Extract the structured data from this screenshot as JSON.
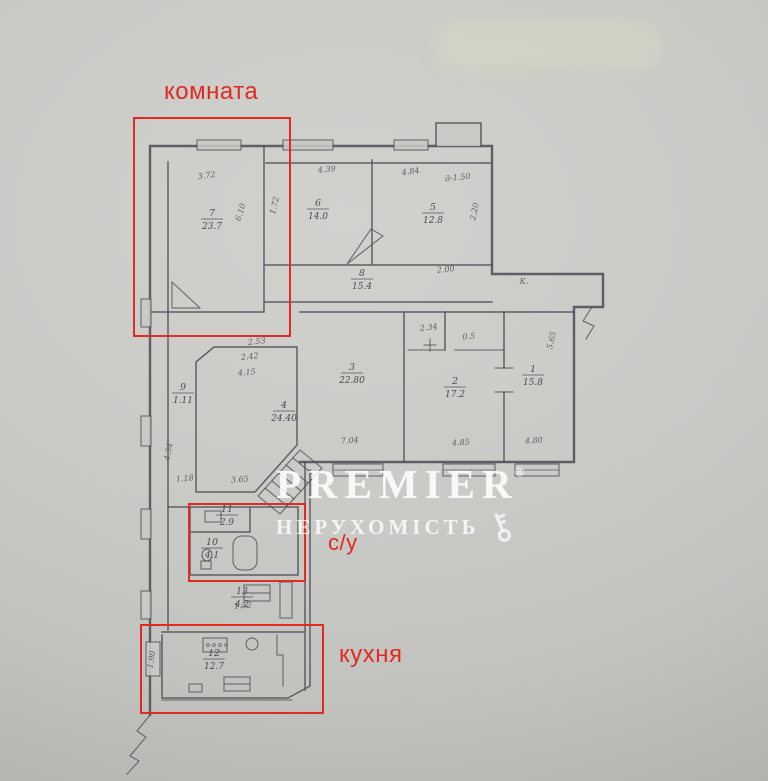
{
  "labels": {
    "room": "комната",
    "bathroom": "с/у",
    "kitchen": "кухня"
  },
  "watermark": {
    "brand": "PREMIER",
    "reg": "®",
    "subtitle": "НЕРУХОМІСТЬ",
    "key_icon": "key-icon"
  },
  "colors": {
    "annotation": "#e02a22",
    "ink": "#4e5055",
    "paper": "#c9c9c6",
    "watermark": "#ffffff"
  },
  "plan": {
    "rooms": [
      {
        "n": "7",
        "a": "23.7",
        "x": 212,
        "y": 216
      },
      {
        "n": "6",
        "a": "14.0",
        "x": 318,
        "y": 206
      },
      {
        "n": "5",
        "a": "12.8",
        "x": 433,
        "y": 210
      },
      {
        "n": "8",
        "a": "15.4",
        "x": 362,
        "y": 276
      },
      {
        "n": "9",
        "a": "1.11",
        "x": 183,
        "y": 390
      },
      {
        "n": "4",
        "a": "24.40",
        "x": 284,
        "y": 408
      },
      {
        "n": "3",
        "a": "22.80",
        "x": 352,
        "y": 370
      },
      {
        "n": "2",
        "a": "17.2",
        "x": 455,
        "y": 384
      },
      {
        "n": "1",
        "a": "15.8",
        "x": 533,
        "y": 372
      },
      {
        "n": "11",
        "a": "2.9",
        "x": 227,
        "y": 512
      },
      {
        "n": "10",
        "a": "4.1",
        "x": 212,
        "y": 545
      },
      {
        "n": "13",
        "a": "4.2",
        "x": 242,
        "y": 594
      },
      {
        "n": "12",
        "a": "12.7",
        "x": 214,
        "y": 656
      }
    ],
    "dims": [
      {
        "t": "3.72",
        "x": 207,
        "y": 178,
        "r": -8
      },
      {
        "t": "6.10",
        "x": 243,
        "y": 213,
        "r": -72
      },
      {
        "t": "1.72",
        "x": 277,
        "y": 206,
        "r": -76
      },
      {
        "t": "4.39",
        "x": 327,
        "y": 172,
        "r": -6
      },
      {
        "t": "4.84",
        "x": 411,
        "y": 174,
        "r": -8
      },
      {
        "t": "д-1.50",
        "x": 458,
        "y": 180,
        "r": -6
      },
      {
        "t": "2.20",
        "x": 477,
        "y": 212,
        "r": -78
      },
      {
        "t": "2.00",
        "x": 446,
        "y": 272,
        "r": -5
      },
      {
        "t": "К.",
        "x": 524,
        "y": 284,
        "r": 0
      },
      {
        "t": "2.53",
        "x": 257,
        "y": 344,
        "r": -6
      },
      {
        "t": "2.42",
        "x": 250,
        "y": 359,
        "r": -6
      },
      {
        "t": "4.15",
        "x": 247,
        "y": 375,
        "r": -5
      },
      {
        "t": "3.65",
        "x": 240,
        "y": 482,
        "r": -4
      },
      {
        "t": "1.18",
        "x": 185,
        "y": 481,
        "r": -5
      },
      {
        "t": "4.54",
        "x": 171,
        "y": 452,
        "r": -78
      },
      {
        "t": "7.04",
        "x": 350,
        "y": 443,
        "r": -4
      },
      {
        "t": "2.34",
        "x": 429,
        "y": 330,
        "r": -6
      },
      {
        "t": "0.5",
        "x": 469,
        "y": 339,
        "r": -4
      },
      {
        "t": "4.85",
        "x": 461,
        "y": 445,
        "r": -4
      },
      {
        "t": "4.80",
        "x": 534,
        "y": 443,
        "r": -4
      },
      {
        "t": "5.65",
        "x": 554,
        "y": 341,
        "r": -76
      },
      {
        "t": "1.52",
        "x": 243,
        "y": 608,
        "r": -4
      },
      {
        "t": "1.90",
        "x": 154,
        "y": 660,
        "r": -80
      }
    ]
  }
}
